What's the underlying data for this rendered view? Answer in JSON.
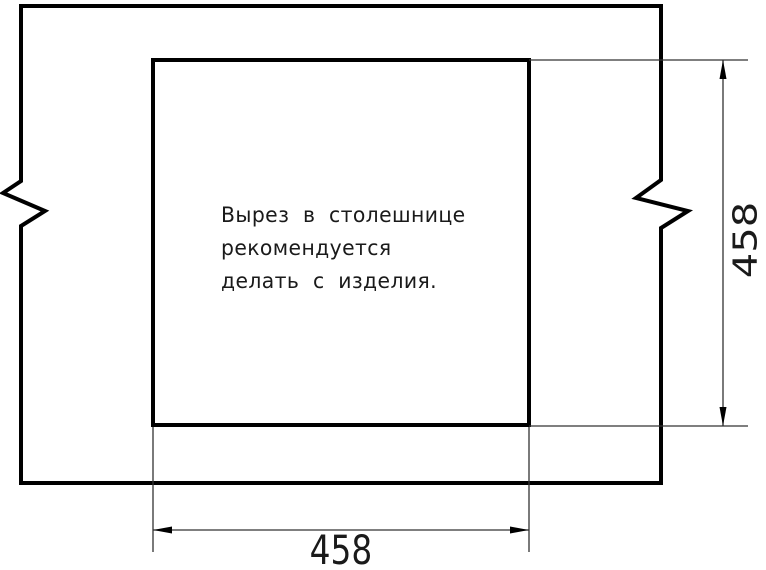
{
  "drawing": {
    "kind": "countertop-cutout-dimension-drawing",
    "note": {
      "lines": [
        "Вырез в столешнице",
        "рекомендуется",
        "делать с изделия."
      ]
    },
    "dimensions": {
      "cutout_width": "458",
      "cutout_height": "458"
    },
    "colors": {
      "background": "#ffffff",
      "outline": "#000000",
      "thin_line": "#333333",
      "text": "#1a1a1a"
    }
  }
}
